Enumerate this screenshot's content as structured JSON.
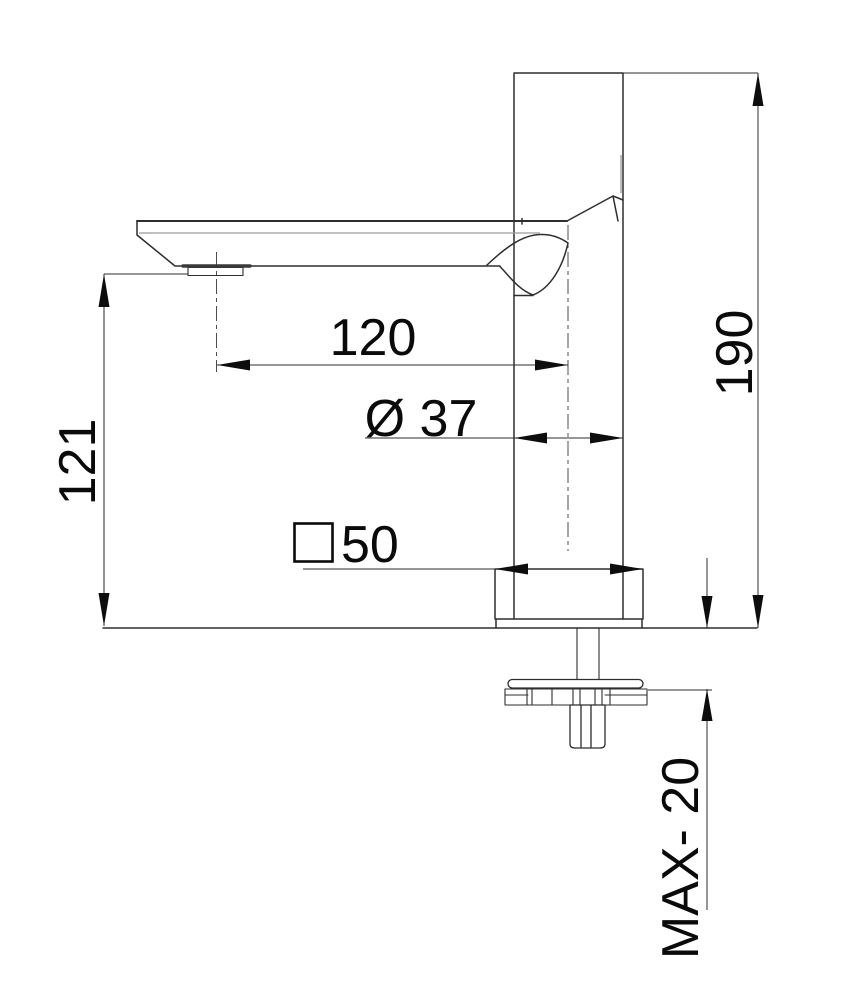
{
  "drawing": {
    "kind": "faucet-dimension-drawing",
    "dimensions": {
      "spout_reach": "120",
      "body_diameter": "Ø 37",
      "base_square_value": "50",
      "base_square_symbol": "□",
      "spout_height": "121",
      "total_height": "190",
      "max_counter_thickness": "MAX- 20"
    },
    "colors": {
      "outline": "#2e2e2e",
      "secondary_line": "#9b9b9b",
      "dimension_line": "#2e2e2e",
      "arrow_fill": "#0d0d0d",
      "text": "#0a0a0a"
    }
  }
}
